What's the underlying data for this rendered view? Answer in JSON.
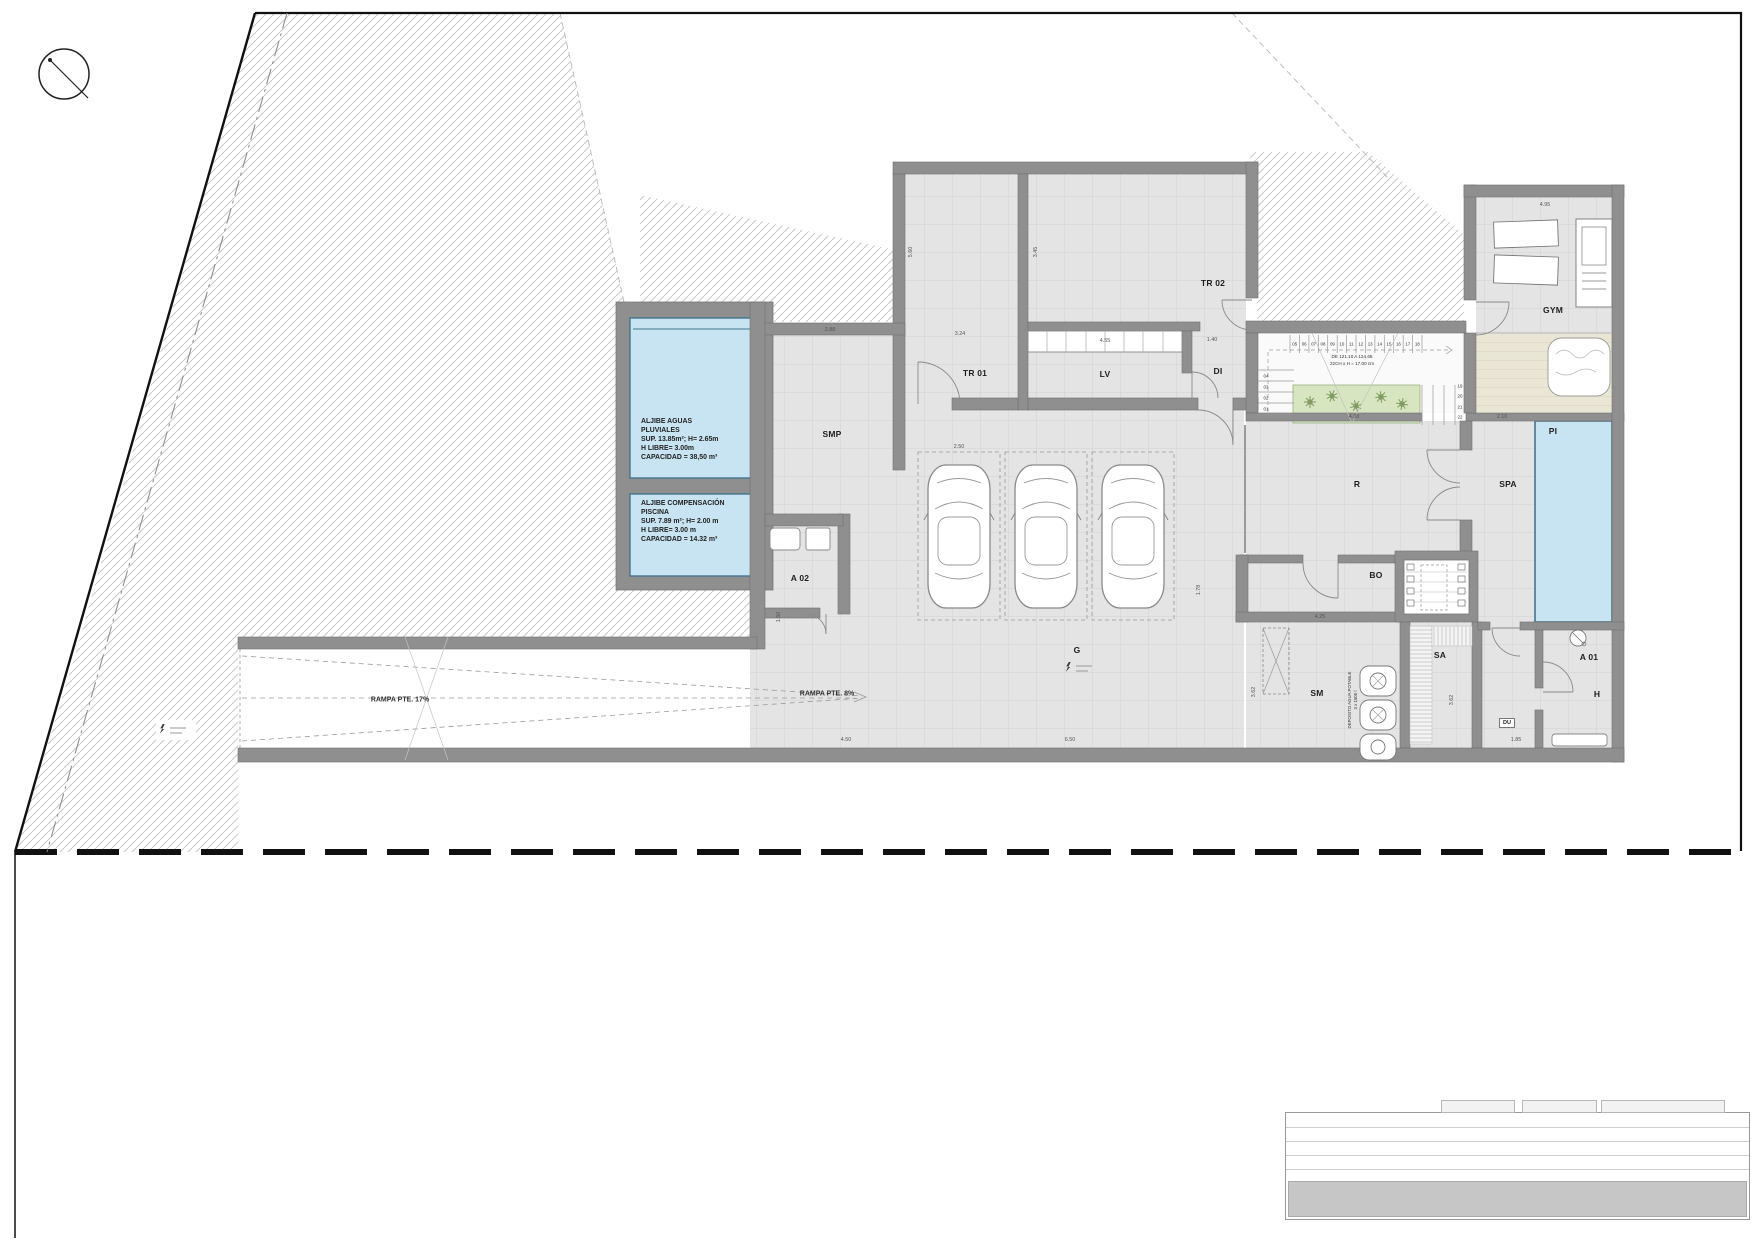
{
  "sheet": {
    "type": "architectural-floor-plan",
    "level": "basement"
  },
  "colors": {
    "wall": "#8f8f8f",
    "floor": "#e4e4e4",
    "grid_line": "#d2d2d2",
    "water": "#c8e3f2",
    "water_border": "#44758f",
    "planter": "#d7e5c1",
    "plant_stroke": "#7f9a5f",
    "deck": "#eae6d5",
    "hatch": "#c9c9c9",
    "border_black": "#111111"
  },
  "rooms": [
    {
      "id": "smp",
      "label": "SMP",
      "x": 832,
      "y": 434
    },
    {
      "id": "tr01",
      "label": "TR 01",
      "x": 975,
      "y": 373
    },
    {
      "id": "tr02",
      "label": "TR 02",
      "x": 1213,
      "y": 283
    },
    {
      "id": "lv",
      "label": "LV",
      "x": 1105,
      "y": 374
    },
    {
      "id": "di",
      "label": "DI",
      "x": 1218,
      "y": 371
    },
    {
      "id": "g",
      "label": "G",
      "x": 1077,
      "y": 650
    },
    {
      "id": "a02",
      "label": "A 02",
      "x": 800,
      "y": 578
    },
    {
      "id": "r",
      "label": "R",
      "x": 1357,
      "y": 484
    },
    {
      "id": "spa",
      "label": "SPA",
      "x": 1508,
      "y": 484
    },
    {
      "id": "pi",
      "label": "PI",
      "x": 1553,
      "y": 431
    },
    {
      "id": "gym",
      "label": "GYM",
      "x": 1553,
      "y": 310
    },
    {
      "id": "bo",
      "label": "BO",
      "x": 1376,
      "y": 575
    },
    {
      "id": "sm",
      "label": "SM",
      "x": 1317,
      "y": 693
    },
    {
      "id": "sa",
      "label": "SA",
      "x": 1440,
      "y": 655
    },
    {
      "id": "a01",
      "label": "A 01",
      "x": 1589,
      "y": 657
    },
    {
      "id": "h",
      "label": "H",
      "x": 1597,
      "y": 694
    }
  ],
  "notes": {
    "aljibe1": [
      "ALJIBE AGUAS",
      "PLUVIALES",
      "SUP. 13.85m²; H= 2.65m",
      "H LIBRE= 3.00m",
      "CAPACIDAD = 38,50 m³"
    ],
    "aljibe2": [
      "ALJIBE COMPENSACIÓN",
      "PISCINA",
      "SUP. 7.89 m²; H= 2.00 m",
      "H LIBRE= 3.00 m",
      "CAPACIDAD = 14.32 m³"
    ],
    "ramp_main": "RAMPA PTE. 17%",
    "ramp_garage": "RAMPA PTE. 8%",
    "stair_note": [
      "DE 121.10 A 124.65",
      "22CH x H = 17.00 cm"
    ],
    "tank_note": [
      "DEPOSITO AGUA POTABLE",
      "3 x 1500 l"
    ],
    "du_label": "DU"
  },
  "stairs": {
    "upper_flight": [
      "05",
      "06",
      "07",
      "08",
      "09",
      "10",
      "11",
      "12",
      "13",
      "14",
      "15",
      "16",
      "17",
      "18"
    ],
    "lower_flight": [
      "04",
      "03",
      "02",
      "01"
    ],
    "right_flight": [
      "19",
      "20",
      "21",
      "22"
    ]
  },
  "dimensions": [
    {
      "t": "2.88",
      "x": 830,
      "y": 330,
      "r": 0
    },
    {
      "t": "3.24",
      "x": 960,
      "y": 334,
      "r": 0
    },
    {
      "t": "4.55",
      "x": 1105,
      "y": 341,
      "r": 0
    },
    {
      "t": "1.40",
      "x": 1212,
      "y": 340,
      "r": 0
    },
    {
      "t": "2.50",
      "x": 959,
      "y": 447,
      "r": 0
    },
    {
      "t": "4.25",
      "x": 1320,
      "y": 617,
      "r": 0
    },
    {
      "t": "4.38",
      "x": 1354,
      "y": 417,
      "r": 0
    },
    {
      "t": "2.10",
      "x": 1502,
      "y": 417,
      "r": 0
    },
    {
      "t": "4.95",
      "x": 1545,
      "y": 205,
      "r": 0
    },
    {
      "t": "4.50",
      "x": 846,
      "y": 740,
      "r": 0
    },
    {
      "t": "6.50",
      "x": 1070,
      "y": 740,
      "r": 0
    },
    {
      "t": "1.85",
      "x": 1516,
      "y": 740,
      "r": 0
    },
    {
      "t": "5.60",
      "x": 911,
      "y": 252,
      "r": 90
    },
    {
      "t": "3.45",
      "x": 1036,
      "y": 252,
      "r": 90
    },
    {
      "t": "1.78",
      "x": 1199,
      "y": 590,
      "r": 90
    },
    {
      "t": "1.50",
      "x": 779,
      "y": 617,
      "r": 90
    },
    {
      "t": "3.62",
      "x": 1254,
      "y": 692,
      "r": 90
    },
    {
      "t": "3.62",
      "x": 1452,
      "y": 700,
      "r": 90
    }
  ]
}
